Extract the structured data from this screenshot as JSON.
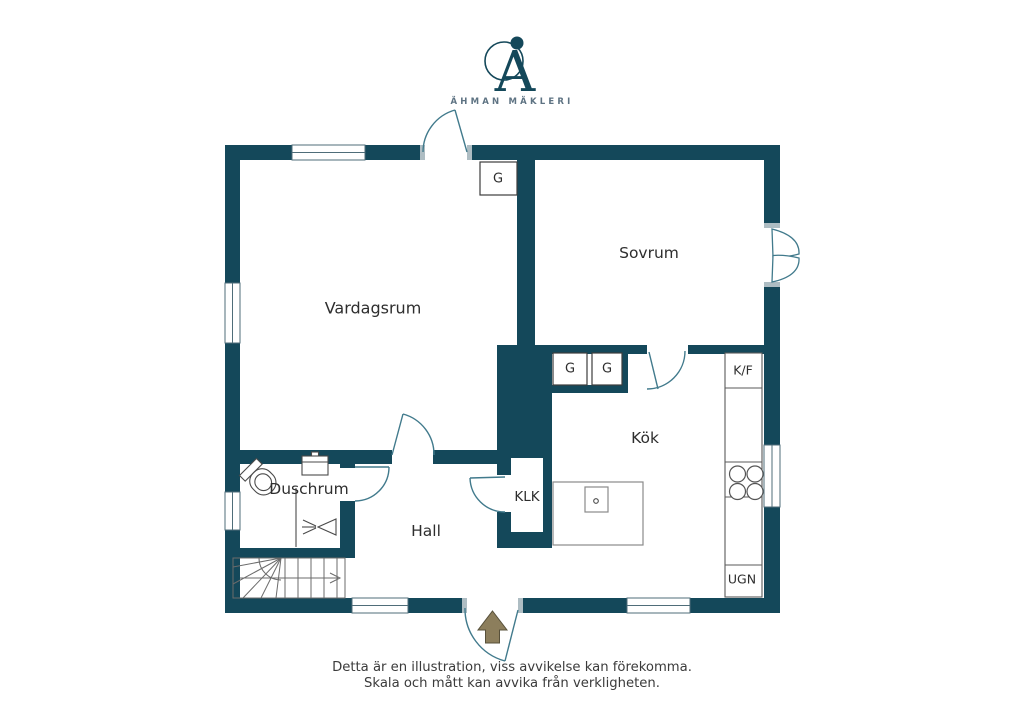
{
  "logo": {
    "monogram": "A",
    "name": "ÄHMAN MÄKLERI"
  },
  "rooms": {
    "vardagsrum": "Vardagsrum",
    "sovrum": "Sovrum",
    "kok": "Kök",
    "hall": "Hall",
    "duschrum": "Duschrum",
    "klk": "KLK"
  },
  "fixtures": {
    "wardrobe": "G",
    "fridge_freezer": "K/F",
    "oven": "UGN"
  },
  "footer": {
    "line1": "Detta är en illustration, viss avvikelse kan förekomma.",
    "line2": "Skala och mått kan avvika från verkligheten."
  },
  "colors": {
    "wall": "#14485A",
    "door_swing": "#417A8C",
    "entry_arrow": "#8C7E5C",
    "entry_arrow_outline": "#57503A",
    "outline": "#3D3D3D"
  }
}
